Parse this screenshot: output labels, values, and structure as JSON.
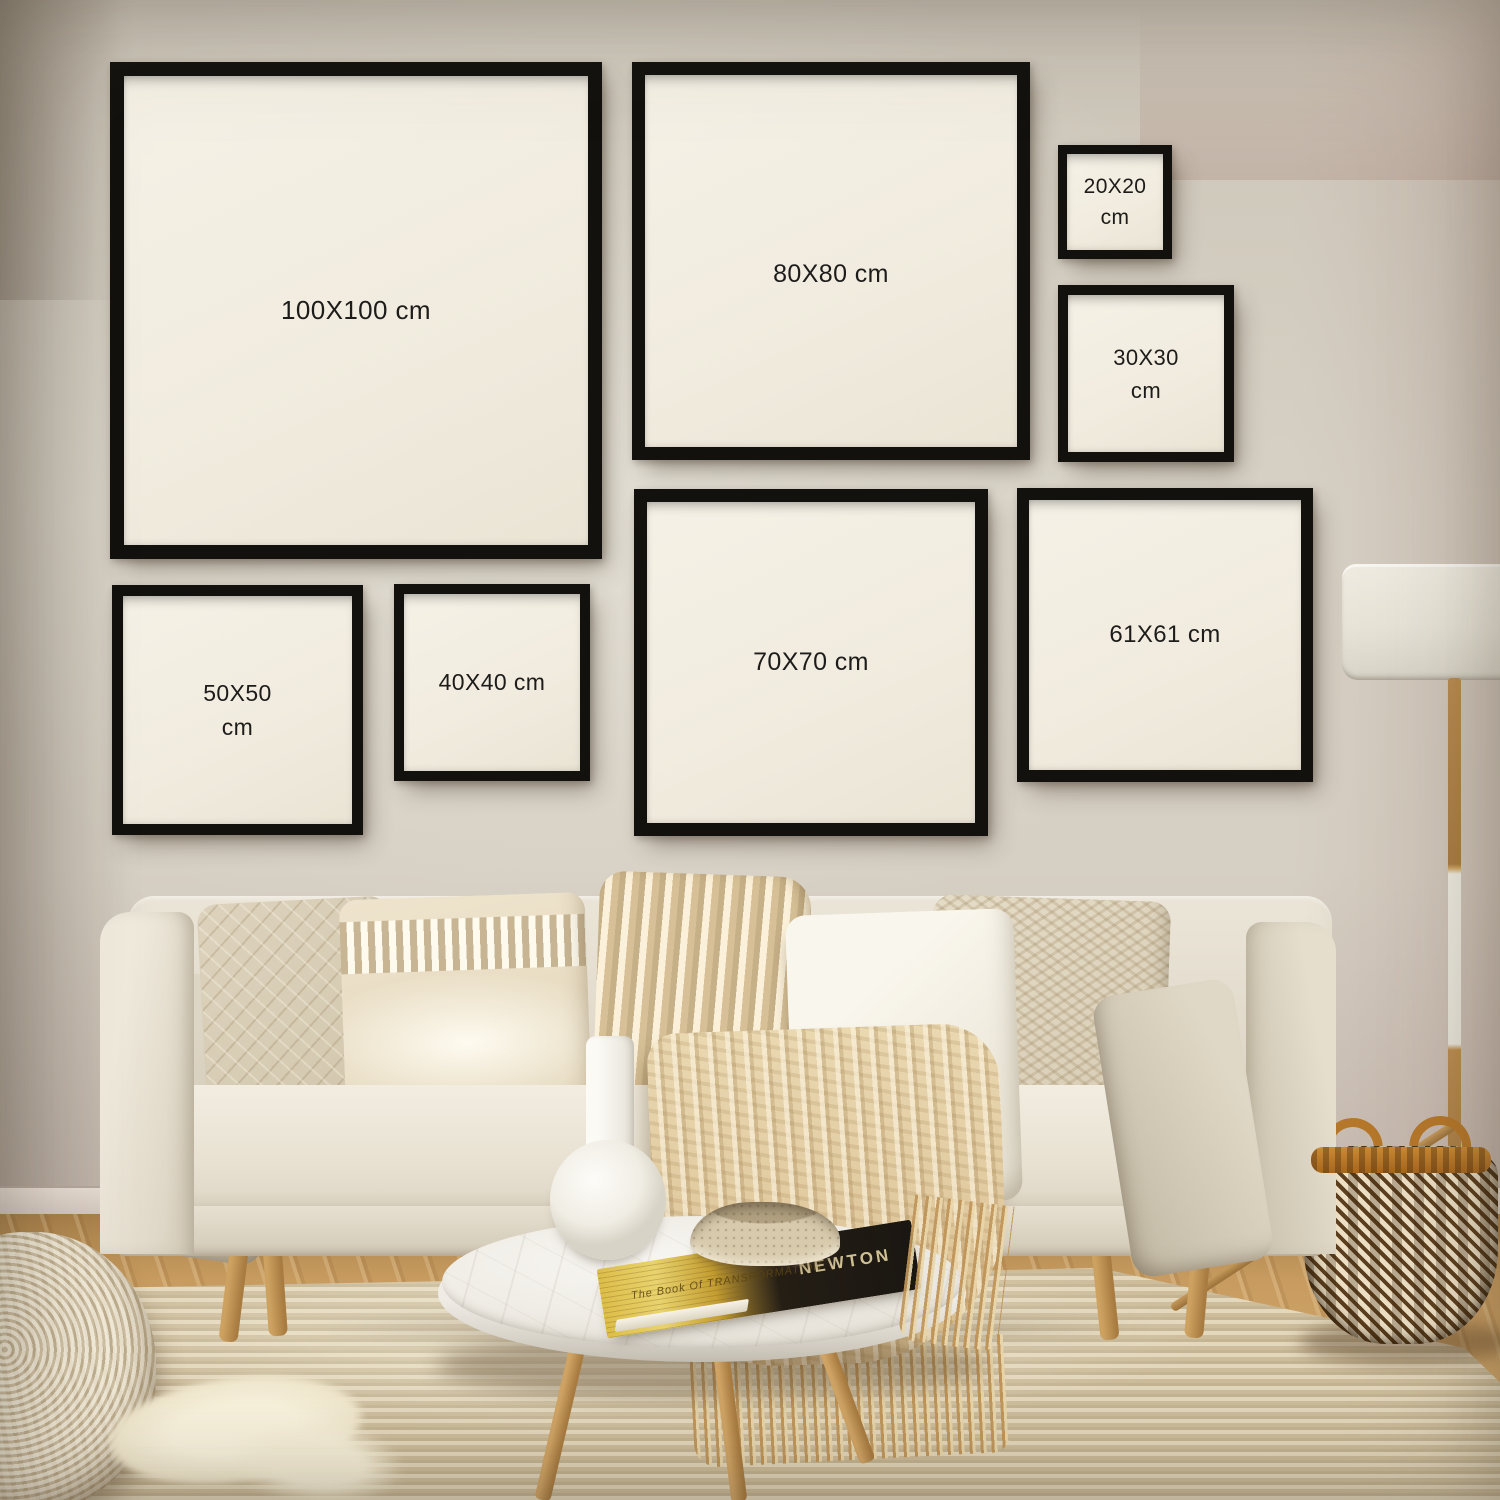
{
  "frames": [
    {
      "id": "100x100",
      "label": "100X100 cm"
    },
    {
      "id": "80x80",
      "label": "80X80 cm"
    },
    {
      "id": "20x20",
      "label": "20X20 cm"
    },
    {
      "id": "30x30",
      "label": "30X30 cm"
    },
    {
      "id": "50x50",
      "label": "50X50 cm"
    },
    {
      "id": "40x40",
      "label": "40X40 cm"
    },
    {
      "id": "70x70",
      "label": "70X70 cm"
    },
    {
      "id": "61x61",
      "label": "61X61 cm"
    }
  ],
  "books": {
    "spine_secondary": "The Book Of TRANSFORMATION",
    "spine_primary": "NEWTON"
  },
  "colors": {
    "frame_border": "#12110e",
    "frame_canvas": "#f3efe4",
    "label_text": "#1d1c1a",
    "wall": "#d3ccc0",
    "sofa_fabric": "#e7e1d4",
    "throw": "#e3d0aa",
    "rug": "#d7c9aa",
    "wood_floor": "#c89c60",
    "basket_dark": "#5c3f1e",
    "basket_rim": "#b5772a",
    "lamp_shade": "#e7e3d7",
    "marble": "#f2efe9"
  }
}
